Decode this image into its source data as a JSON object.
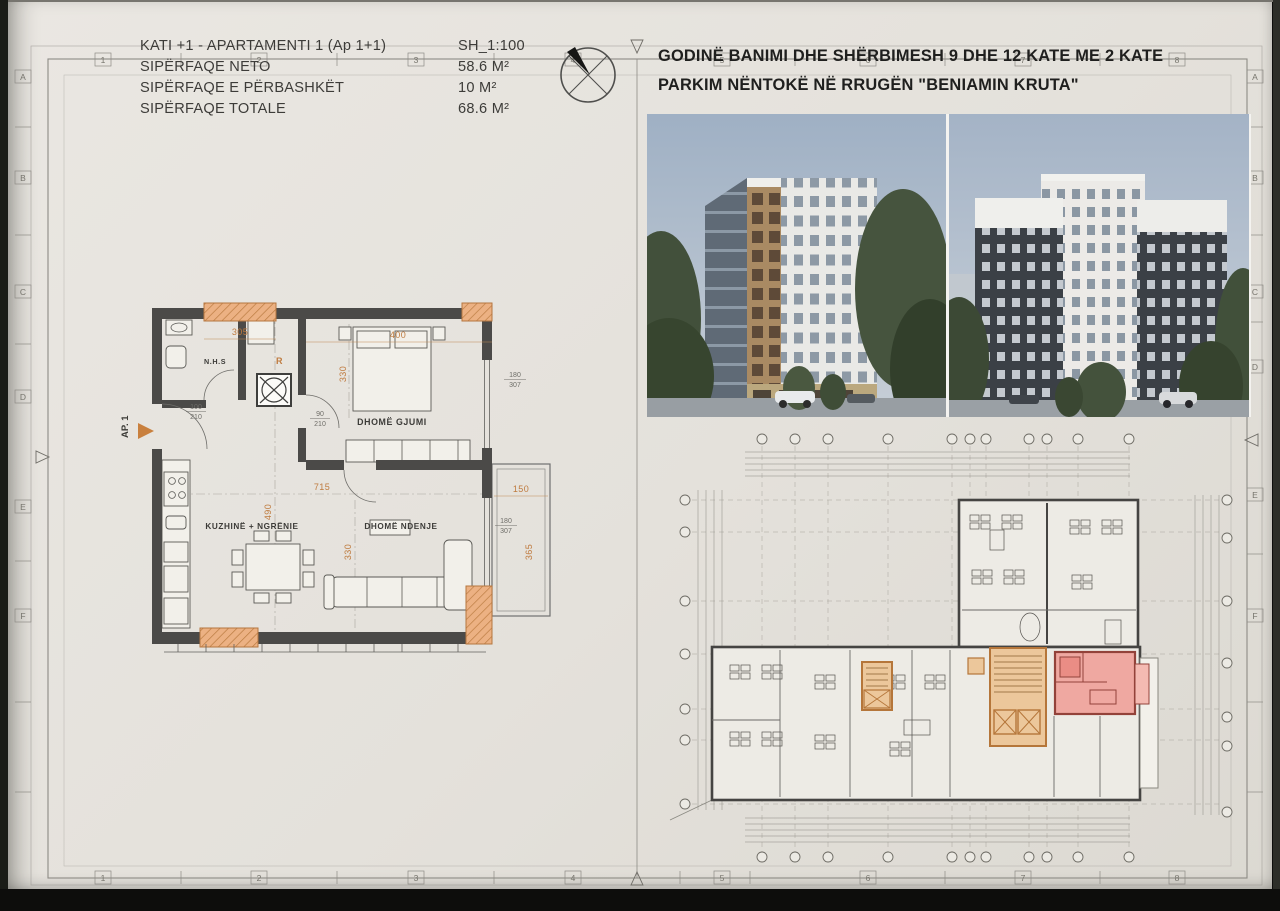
{
  "title_block": {
    "title": "KATI +1 - APARTAMENTI 1  (Ap 1+1)",
    "scale": "SH_1:100",
    "rows": [
      {
        "label": "SIPËRFAQE NETO",
        "value": "58.6 M²"
      },
      {
        "label": "SIPËRFAQE E PËRBASHKËT",
        "value": "10 M²"
      },
      {
        "label": "SIPËRFAQE TOTALE",
        "value": "68.6 M²"
      }
    ]
  },
  "project_title": {
    "line1": "GODINË BANIMI DHE SHËRBIMESH 9 DHE 12 KATE ME 2 KATE",
    "line2": "PARKIM NËNTOKË NË RRUGËN \"BENIAMIN KRUTA\""
  },
  "frame": {
    "cols": [
      "1",
      "2",
      "3",
      "4",
      "5",
      "6",
      "7",
      "8"
    ],
    "rows": [
      "A",
      "B",
      "C",
      "D",
      "E",
      "F"
    ]
  },
  "apartment_plan": {
    "unit_label": "AP. 1",
    "riser_label": "R",
    "rooms": {
      "bath": "N.H.S",
      "bedroom": "DHOMË GJUMI",
      "kitchen": "KUZHINË + NGRËNIE",
      "living": "DHOMË NDENJE"
    },
    "dims": {
      "w305": "305",
      "w400": "400",
      "bed330": "330",
      "w715": "715",
      "k490": "490",
      "l330": "330",
      "b150": "150",
      "b365": "365",
      "win180a": "180",
      "win307a": "307",
      "win180b": "180",
      "win307b": "307",
      "door100": "100",
      "door210a": "210",
      "door90": "90",
      "door210b": "210"
    }
  },
  "colors": {
    "paper": "#e6e3de",
    "wall": "#4b4a48",
    "dim_orange": "#bf7b3f",
    "pilaster_orange": "#ecb183",
    "core_orange": "#ecc79b",
    "highlight_pink": "#efa29b",
    "sky_blue": "#aebac9"
  }
}
